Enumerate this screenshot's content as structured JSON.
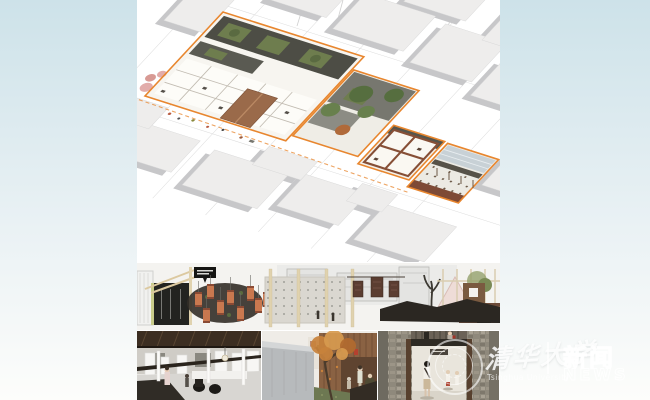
{
  "watermark": {
    "university_script": "清华大学",
    "university_latin": "Tsinghua University",
    "divider": "|",
    "news_cn": "新闻",
    "news_en": "NEWS"
  },
  "colors": {
    "bg_top": "#cde2e9",
    "bg_mid": "#e9f1f4",
    "bg_bottom": "#fdfdfb",
    "panel_bg": "#ffffff",
    "accent_orange": "#e8862e",
    "roof_dark": "#4d4d45",
    "courtyard_green": "#6e7d4e",
    "wall_brown": "#864f36",
    "lantern_red": "#c9784f",
    "wood_light": "#e0d2ae",
    "concrete": "#dad7d0",
    "context_gray": "#eeedec",
    "moss_green": "#6d7852",
    "autumn_orange": "#c8823c"
  }
}
